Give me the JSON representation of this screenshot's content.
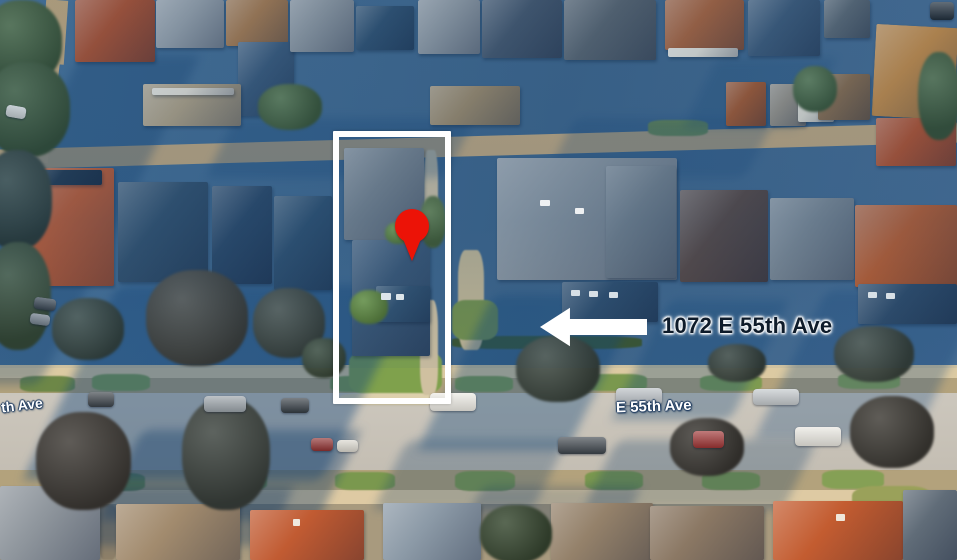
{
  "image_type": "aerial-satellite-photo",
  "annotations": {
    "address": "1072 E 55th Ave",
    "address_text_color": "#0e1b2a",
    "address_halo_color": "#ffffff",
    "arrow_direction": "left",
    "arrow_color": "#ffffff",
    "highlight_box_color": "#ffffff",
    "pin_color": "#ec1307"
  },
  "streets": {
    "center": "E 55th Ave",
    "left_partial": "th Ave",
    "label_color": "#ffffff",
    "label_outline_color": "#1d3a5f"
  },
  "scene": {
    "layers": [
      {
        "name": "ground-shadow",
        "cls": "sh",
        "items": [
          [
            0,
            55,
            120,
            330,
            "rgba(20,62,110,0.32)"
          ],
          [
            70,
            285,
            300,
            195,
            "rgba(19,70,122,0.42)"
          ],
          [
            455,
            295,
            150,
            155,
            "rgba(19,70,122,0.38)"
          ],
          [
            640,
            300,
            120,
            120,
            "rgba(19,70,122,0.32)"
          ],
          [
            790,
            290,
            160,
            150,
            "rgba(19,70,122,0.30)"
          ],
          [
            120,
            430,
            220,
            90,
            "rgba(18,60,105,0.38)"
          ],
          [
            390,
            440,
            160,
            70,
            "rgba(18,60,105,0.28)"
          ],
          [
            600,
            440,
            200,
            70,
            "rgba(18,60,105,0.28)"
          ],
          [
            220,
            118,
            240,
            60,
            "rgba(22,70,118,0.30)"
          ],
          [
            560,
            118,
            200,
            60,
            "rgba(22,70,118,0.26)"
          ],
          [
            40,
            486,
            240,
            60,
            "rgba(18,55,98,0.34)"
          ],
          [
            470,
            486,
            160,
            50,
            "rgba(18,55,98,0.26)"
          ],
          [
            700,
            58,
            120,
            70,
            "rgba(22,70,118,0.24)"
          ]
        ]
      },
      {
        "name": "grass-patch",
        "cls": "gp",
        "items": [
          [
            92,
            374,
            58,
            17,
            "#7e9b50"
          ],
          [
            330,
            376,
            62,
            16,
            "#7a984e"
          ],
          [
            455,
            376,
            58,
            16,
            "#7e9b50"
          ],
          [
            585,
            374,
            62,
            17,
            "#7a984e"
          ],
          [
            700,
            375,
            62,
            16,
            "#7e9b50"
          ],
          [
            838,
            373,
            62,
            16,
            "#85a055"
          ],
          [
            20,
            376,
            55,
            16,
            "#6d8747"
          ],
          [
            212,
            472,
            55,
            18,
            "#75914b"
          ],
          [
            335,
            472,
            60,
            18,
            "#7a984e"
          ],
          [
            455,
            471,
            60,
            20,
            "#7e9b50"
          ],
          [
            585,
            471,
            58,
            19,
            "#7a984e"
          ],
          [
            702,
            472,
            58,
            18,
            "#7e9b50"
          ],
          [
            822,
            470,
            62,
            19,
            "#85a055"
          ],
          [
            90,
            473,
            55,
            18,
            "#6d8747"
          ],
          [
            349,
            349,
            93,
            47,
            "#7fa14c"
          ],
          [
            340,
            393,
            112,
            12,
            "#ddd0ac"
          ],
          [
            852,
            486,
            80,
            34,
            "#9aa15a"
          ],
          [
            452,
            336,
            190,
            13,
            "#3b5531"
          ],
          [
            424,
            150,
            14,
            96,
            "#d3c4a5"
          ],
          [
            420,
            300,
            18,
            95,
            "#cfc0a0"
          ],
          [
            458,
            250,
            26,
            100,
            "#c4b794"
          ],
          [
            452,
            300,
            46,
            40,
            "#74904c"
          ],
          [
            99,
            505,
            18,
            55,
            "#8d7f68"
          ],
          [
            648,
            120,
            60,
            16,
            "#6f8c4b"
          ]
        ]
      },
      {
        "name": "house-roof",
        "cls": "rf",
        "items": [
          [
            75,
            0,
            80,
            62,
            "#ad5130"
          ],
          [
            156,
            0,
            68,
            48,
            "#99a1a9"
          ],
          [
            226,
            0,
            62,
            46,
            "#a87a4e"
          ],
          [
            238,
            42,
            56,
            74,
            "#3a5878"
          ],
          [
            290,
            0,
            64,
            52,
            "#8e969e"
          ],
          [
            356,
            6,
            58,
            44,
            "#30506f"
          ],
          [
            418,
            0,
            62,
            54,
            "#929aa2"
          ],
          [
            482,
            0,
            80,
            58,
            "#45566b"
          ],
          [
            564,
            0,
            92,
            60,
            "#59636d"
          ],
          [
            665,
            0,
            79,
            50,
            "#a9623b"
          ],
          [
            668,
            48,
            70,
            9,
            "#e6e2d8"
          ],
          [
            748,
            0,
            72,
            56,
            "#3d5977"
          ],
          [
            824,
            0,
            46,
            38,
            "#5b6772"
          ],
          [
            874,
            26,
            82,
            92,
            "#c88c46",
            3
          ],
          [
            143,
            84,
            98,
            42,
            "#b3a284"
          ],
          [
            152,
            88,
            82,
            7,
            "#e9e3d6"
          ],
          [
            430,
            86,
            90,
            39,
            "#9f8a69"
          ],
          [
            726,
            82,
            40,
            44,
            "#a5582f"
          ],
          [
            770,
            84,
            36,
            42,
            "#9a9286"
          ],
          [
            798,
            88,
            36,
            34,
            "#e3ded2"
          ],
          [
            818,
            74,
            52,
            46,
            "#8a6b4b"
          ],
          [
            876,
            118,
            80,
            48,
            "#b5512c"
          ],
          [
            22,
            168,
            92,
            118,
            "#c05c34"
          ],
          [
            30,
            170,
            72,
            15,
            "#24394f"
          ],
          [
            118,
            182,
            90,
            100,
            "#33506c"
          ],
          [
            212,
            186,
            60,
            98,
            "#2b4766"
          ],
          [
            274,
            196,
            58,
            94,
            "#2f4f6e"
          ],
          [
            344,
            148,
            80,
            92,
            "#7b858f"
          ],
          [
            352,
            240,
            78,
            116,
            "#3b5775"
          ],
          [
            497,
            158,
            180,
            122,
            "#8b949d"
          ],
          [
            606,
            166,
            70,
            112,
            "#75808b"
          ],
          [
            680,
            190,
            88,
            92,
            "#5a4843"
          ],
          [
            770,
            198,
            84,
            82,
            "#7f8993"
          ],
          [
            855,
            205,
            102,
            82,
            "#bc5d2f"
          ],
          [
            562,
            282,
            96,
            40,
            "#2f4d6c"
          ],
          [
            376,
            286,
            54,
            36,
            "#32516f"
          ],
          [
            858,
            284,
            99,
            40,
            "#2e4a68"
          ],
          [
            0,
            486,
            100,
            74,
            "#8f969d"
          ],
          [
            116,
            504,
            124,
            56,
            "#a28b6e"
          ],
          [
            250,
            510,
            114,
            50,
            "#c15b32"
          ],
          [
            383,
            503,
            98,
            57,
            "#8c9aa7"
          ],
          [
            551,
            503,
            102,
            57,
            "#94816a"
          ],
          [
            650,
            506,
            114,
            54,
            "#8b7864"
          ],
          [
            773,
            501,
            130,
            59,
            "#c35c30"
          ],
          [
            903,
            490,
            54,
            70,
            "#606c78"
          ]
        ]
      },
      {
        "name": "tree",
        "cls": "tr",
        "items": [
          [
            -18,
            0,
            80,
            85,
            "#4c6a3e"
          ],
          [
            -15,
            62,
            85,
            95,
            "#45623a"
          ],
          [
            -18,
            150,
            70,
            100,
            "#3a4a42"
          ],
          [
            -15,
            242,
            66,
            108,
            "#43583c"
          ],
          [
            52,
            298,
            72,
            62,
            "#3e4d46"
          ],
          [
            146,
            270,
            102,
            96,
            "#4a4a44"
          ],
          [
            253,
            288,
            72,
            70,
            "#464f48"
          ],
          [
            36,
            412,
            95,
            98,
            "#45413c"
          ],
          [
            182,
            398,
            88,
            112,
            "#434a45"
          ],
          [
            302,
            338,
            44,
            40,
            "#3f4f3e"
          ],
          [
            516,
            336,
            84,
            66,
            "#414c44"
          ],
          [
            708,
            344,
            58,
            38,
            "#3f4a42"
          ],
          [
            834,
            326,
            80,
            56,
            "#424d45"
          ],
          [
            670,
            418,
            74,
            58,
            "#423f3a"
          ],
          [
            850,
            396,
            84,
            72,
            "#45423c"
          ],
          [
            918,
            52,
            42,
            88,
            "#4c6a3e"
          ],
          [
            793,
            66,
            44,
            46,
            "#527445"
          ],
          [
            258,
            84,
            64,
            46,
            "#4f7040"
          ],
          [
            420,
            196,
            26,
            52,
            "#5d7c3d"
          ],
          [
            350,
            290,
            38,
            34,
            "#6f9b3f"
          ],
          [
            385,
            222,
            26,
            22,
            "#6f9b3f"
          ],
          [
            480,
            505,
            72,
            58,
            "#3f5038"
          ]
        ]
      },
      {
        "name": "car",
        "cls": "car",
        "items": [
          [
            88,
            392,
            26,
            15,
            "#3a4148"
          ],
          [
            204,
            396,
            42,
            16,
            "#9aa2a8"
          ],
          [
            281,
            398,
            28,
            15,
            "#343c43"
          ],
          [
            430,
            393,
            46,
            18,
            "#eceae3"
          ],
          [
            616,
            388,
            46,
            17,
            "#b9bfc4"
          ],
          [
            753,
            389,
            46,
            16,
            "#c3c8cb"
          ],
          [
            558,
            437,
            48,
            17,
            "#3d444b"
          ],
          [
            693,
            431,
            31,
            17,
            "#9e3434"
          ],
          [
            795,
            427,
            46,
            19,
            "#e9e7e0"
          ],
          [
            311,
            438,
            22,
            13,
            "#8f3131"
          ],
          [
            337,
            440,
            21,
            12,
            "#dad7ce"
          ],
          [
            34,
            298,
            22,
            12,
            "#3c434a",
            8
          ],
          [
            30,
            314,
            20,
            11,
            "#7c848b",
            8
          ],
          [
            6,
            106,
            20,
            12,
            "#e8e6e0",
            10
          ],
          [
            930,
            2,
            24,
            18,
            "#23292f"
          ]
        ]
      },
      {
        "name": "detail",
        "cls": "dt",
        "items": [
          [
            381,
            293,
            10,
            7,
            "#dde5ea"
          ],
          [
            396,
            294,
            8,
            6,
            "#dde5ea"
          ],
          [
            571,
            290,
            9,
            6,
            "#d8e0e6"
          ],
          [
            589,
            291,
            9,
            6,
            "#d8e0e6"
          ],
          [
            609,
            292,
            9,
            6,
            "#d8e0e6"
          ],
          [
            868,
            292,
            9,
            6,
            "#d8e0e6"
          ],
          [
            886,
            293,
            9,
            6,
            "#d8e0e6"
          ],
          [
            540,
            200,
            10,
            6,
            "#eef0f2"
          ],
          [
            575,
            208,
            9,
            6,
            "#eef0f2"
          ],
          [
            293,
            519,
            7,
            7,
            "#efe9df"
          ],
          [
            836,
            514,
            9,
            7,
            "#efe7da"
          ]
        ]
      }
    ]
  }
}
